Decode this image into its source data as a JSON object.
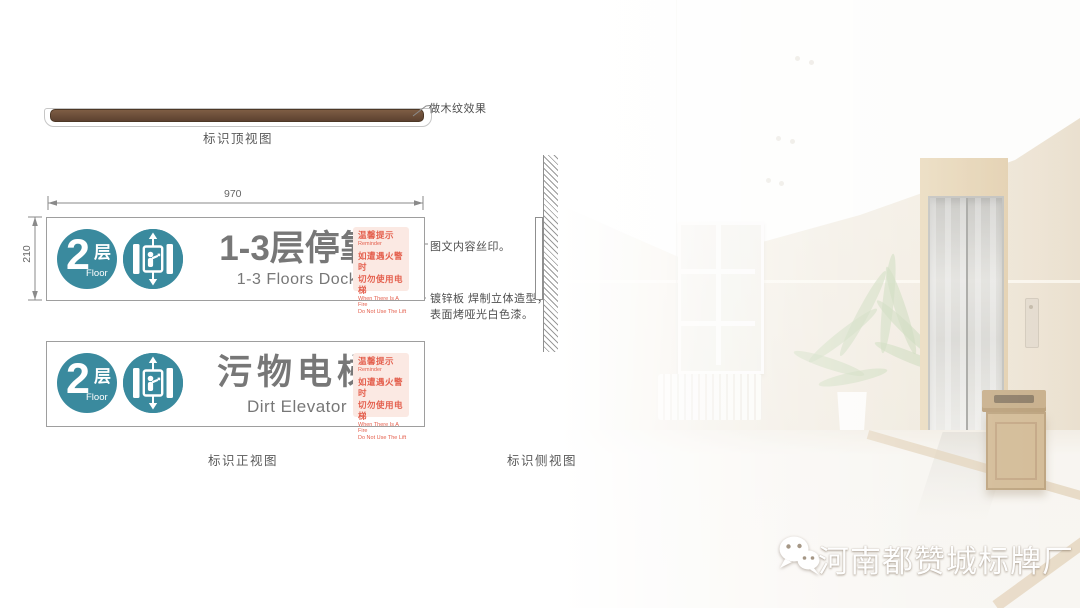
{
  "colors": {
    "badge_teal": "#3a8a9e",
    "warning_red": "#e4604e",
    "warning_bg": "#fbe9e3",
    "wood_dark": "#5c4130",
    "wood_light": "#7e5d44",
    "title_gray": "#777777"
  },
  "top_view": {
    "label": "标识顶视图",
    "note": "做木纹效果"
  },
  "front_view": {
    "label": "标识正视图",
    "dim_width": "970",
    "dim_height": "210",
    "signs": [
      {
        "floor_num": "2",
        "floor_cn": "层",
        "floor_en": "Floor",
        "title": "1-3层停靠",
        "subtitle": "1-3 Floors Dock"
      },
      {
        "floor_num": "2",
        "floor_cn": "层",
        "floor_en": "Floor",
        "title": "污物电梯",
        "subtitle": "Dirt Elevator"
      }
    ],
    "warning": {
      "lines": [
        "温馨提示",
        "Reminder",
        "如遭遇火警时",
        "切勿使用电梯",
        "When There Is A Fire",
        "Do Not Use The Lift"
      ]
    },
    "notes": {
      "silkscreen": "图文内容丝印。",
      "material_line1": "镀锌板 焊制立体造型，",
      "material_line2": "表面烤哑光白色漆。"
    }
  },
  "side_view": {
    "label": "标识侧视图"
  },
  "footer": {
    "brand": "河南都赞城标牌厂"
  }
}
